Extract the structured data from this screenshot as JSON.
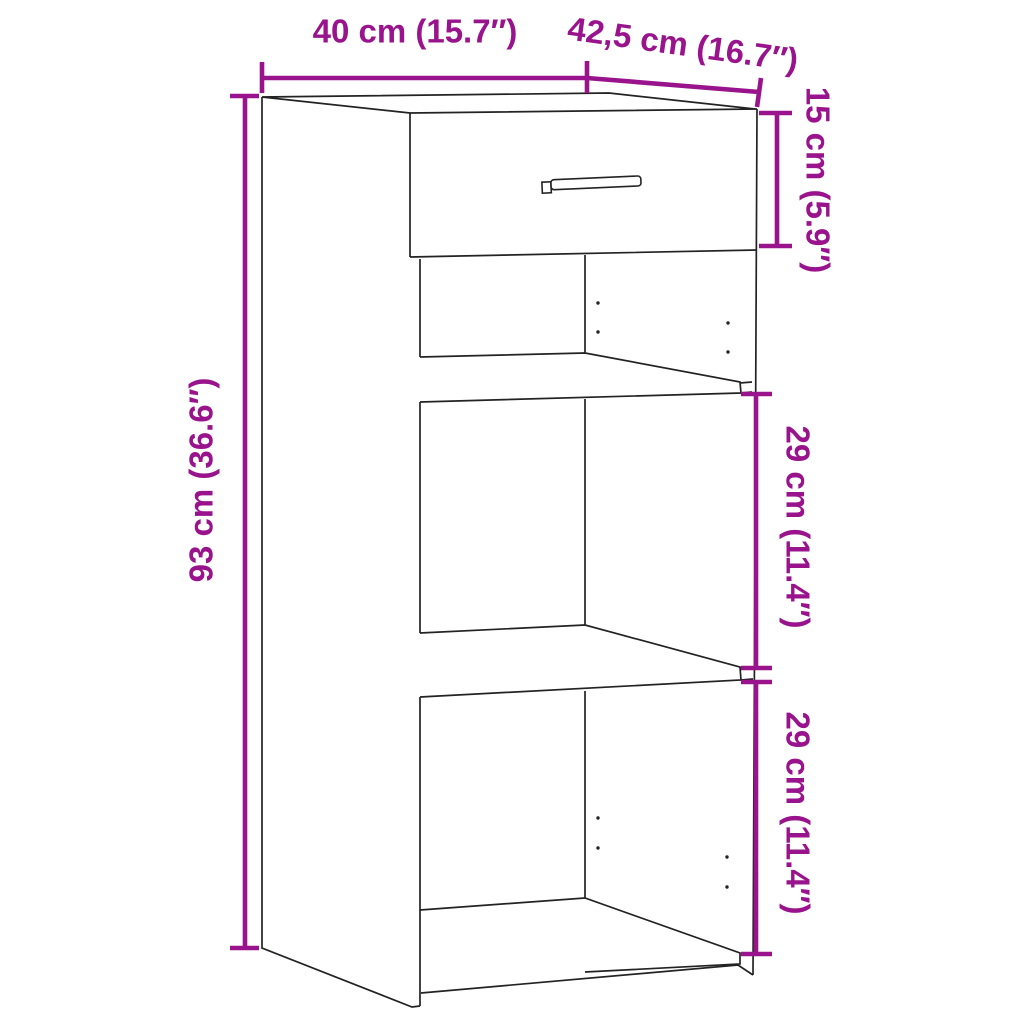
{
  "diagram": {
    "background": "#ffffff",
    "accent_color": "#99148C",
    "outline_color": "#232323",
    "subject": "sideboard with one drawer and two open shelf compartments",
    "labels": {
      "width": "40 cm (15.7″)",
      "depth": "42,5 cm (16.7″)",
      "drawer_height": "15 cm (5.9″)",
      "height": "93 cm (36.6″)",
      "upper_compartment": "29 cm (11.4″)",
      "lower_compartment": "29 cm (11.4″)"
    },
    "dimensions_cm": {
      "width": 40,
      "depth": 42.5,
      "height": 93,
      "drawer_front_height": 15,
      "upper_compartment_height": 29,
      "lower_compartment_height": 29
    },
    "dimensions_inches": {
      "width": 15.7,
      "depth": 16.7,
      "height": 36.6,
      "drawer_front_height": 5.9,
      "upper_compartment_height": 11.4,
      "lower_compartment_height": 11.4
    }
  }
}
